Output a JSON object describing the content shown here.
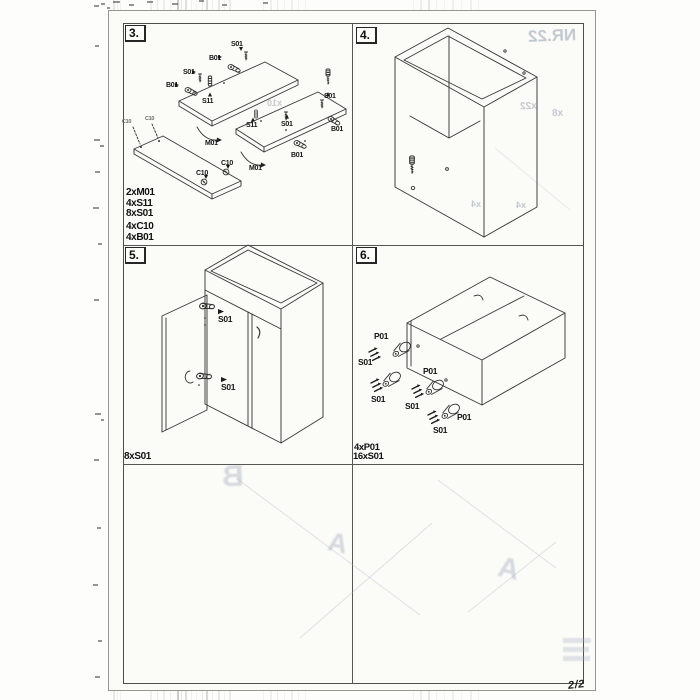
{
  "page": {
    "page_number": "2/2"
  },
  "steps": [
    {
      "number": "3.",
      "parts_list": [
        "2xM01",
        "4xS11",
        "8xS01",
        "4xC10",
        "4xB01"
      ],
      "labels": [
        "S01",
        "B01",
        "S01",
        "B01",
        "S11",
        "S01",
        "S11",
        "S01",
        "B01",
        "B01",
        "M01",
        "M01",
        "C10",
        "C10",
        "C10",
        "C10"
      ]
    },
    {
      "number": "4.",
      "parts_list": [],
      "labels": []
    },
    {
      "number": "5.",
      "parts_list": [
        "8xS01"
      ],
      "labels": [
        "S01",
        "S01"
      ]
    },
    {
      "number": "6.",
      "parts_list": [
        "4xP01",
        "16xS01"
      ],
      "labels": [
        "P01",
        "S01",
        "S01",
        "P01",
        "S01",
        "P01",
        "S01"
      ]
    }
  ],
  "ghost_bleedthrough": {
    "items": [
      "NR.22",
      "x22",
      "x8",
      "x10",
      "x4",
      "x4",
      "B",
      "A",
      "A"
    ]
  },
  "icons": {
    "hinge": "hinge-icon",
    "screw": "screw-icon",
    "dowel": "dowel-icon",
    "cam": "cam-icon",
    "foot": "foot-icon",
    "screw_cluster": "screw-trio-icon",
    "mount_arrow": "curved-arrow-icon",
    "door_handle": "handle-icon"
  }
}
